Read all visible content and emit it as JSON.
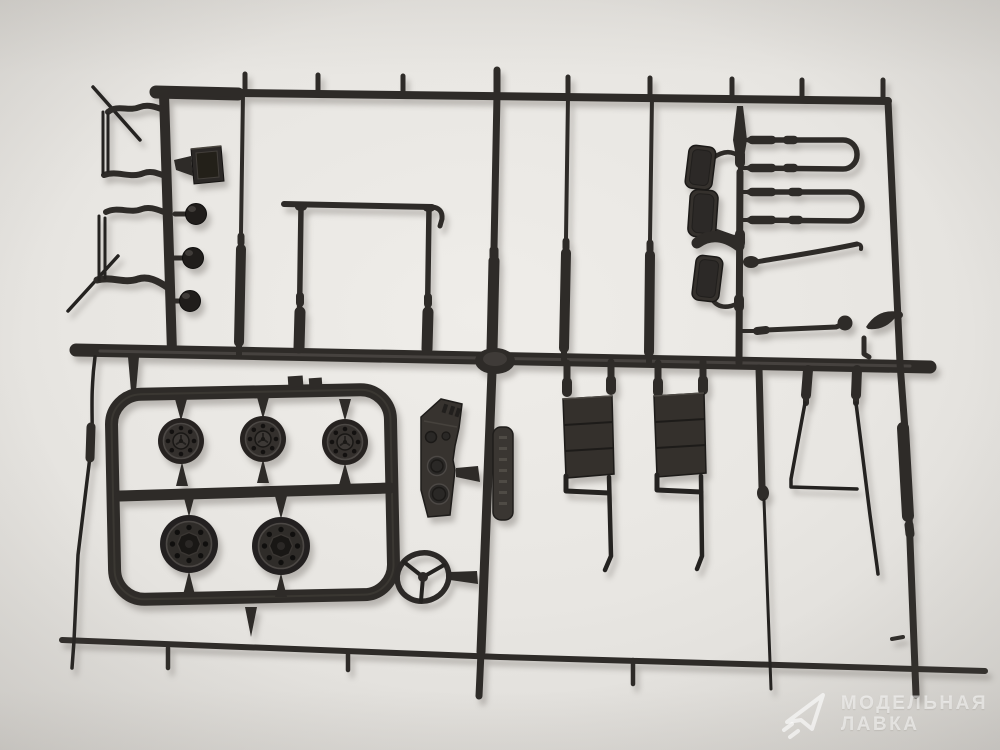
{
  "meta": {
    "type": "photograph",
    "subject": "plastic model kit sprue (parts tree) of dark grey styrene truck detail parts on a light studio background"
  },
  "colors": {
    "background": "#e9e7e3",
    "background_edge": "#d2d0cd",
    "plastic": "#2e2b28",
    "plastic_dark": "#1c1a18",
    "plastic_highlight": "#55504a",
    "watermark": "rgba(255,255,255,0.55)"
  },
  "watermark": {
    "logo": "paper-plane-logo",
    "line1": "МОДЕЛЬНАЯ",
    "line2": "ЛАВКА"
  },
  "parts": [
    {
      "name": "wheel-hub-small",
      "count": 3
    },
    {
      "name": "wheel-rim-large",
      "count": 2
    },
    {
      "name": "steering-wheel",
      "count": 1
    },
    {
      "name": "dashboard-panel",
      "count": 1
    },
    {
      "name": "seat-backrest-with-leg",
      "count": 2
    },
    {
      "name": "rear-view-mirror",
      "count": 3
    },
    {
      "name": "mirror-bracket-u-tube",
      "count": 2
    },
    {
      "name": "wiper-arm",
      "count": 1
    },
    {
      "name": "gear-lever",
      "count": 1
    },
    {
      "name": "leaf-shaped-visor",
      "count": 1
    },
    {
      "name": "wire-bracket-frame",
      "count": 2
    },
    {
      "name": "horn-ball",
      "count": 3
    },
    {
      "name": "mud-flap",
      "count": 1
    },
    {
      "name": "windshield-frame",
      "count": 1
    },
    {
      "name": "shock-absorber-rod",
      "count": 4
    },
    {
      "name": "embossed-part-number-tag",
      "count": 1
    }
  ]
}
